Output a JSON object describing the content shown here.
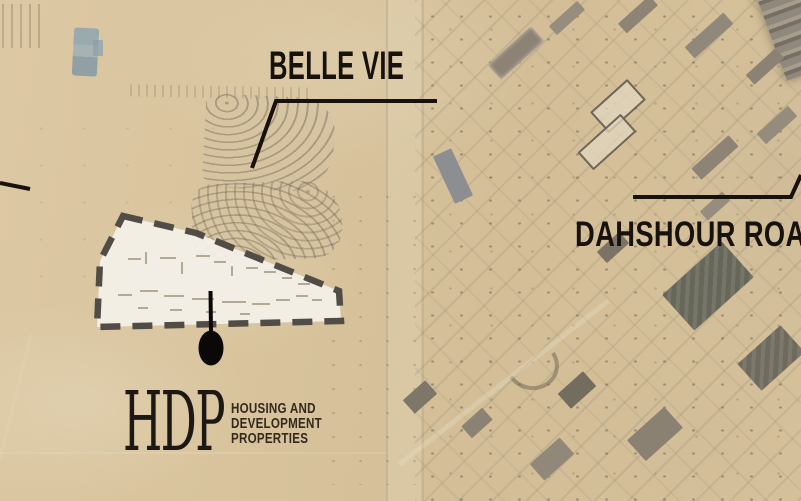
{
  "annotations": {
    "belle_vie_label": "BELLE VIE",
    "dahshour_road_label": "DAHSHOUR ROAD"
  },
  "logo": {
    "acronym": "HDP",
    "lines": [
      "HOUSING AND",
      "DEVELOPMENT",
      "PROPERTIES"
    ]
  },
  "colors": {
    "desert_base": "#d7c29b",
    "annotation_text": "#17120d",
    "leader_line": "#17120d",
    "parcel_fill": "#f4f1e9",
    "parcel_border": "#514d46",
    "marker": "#0b0908"
  }
}
